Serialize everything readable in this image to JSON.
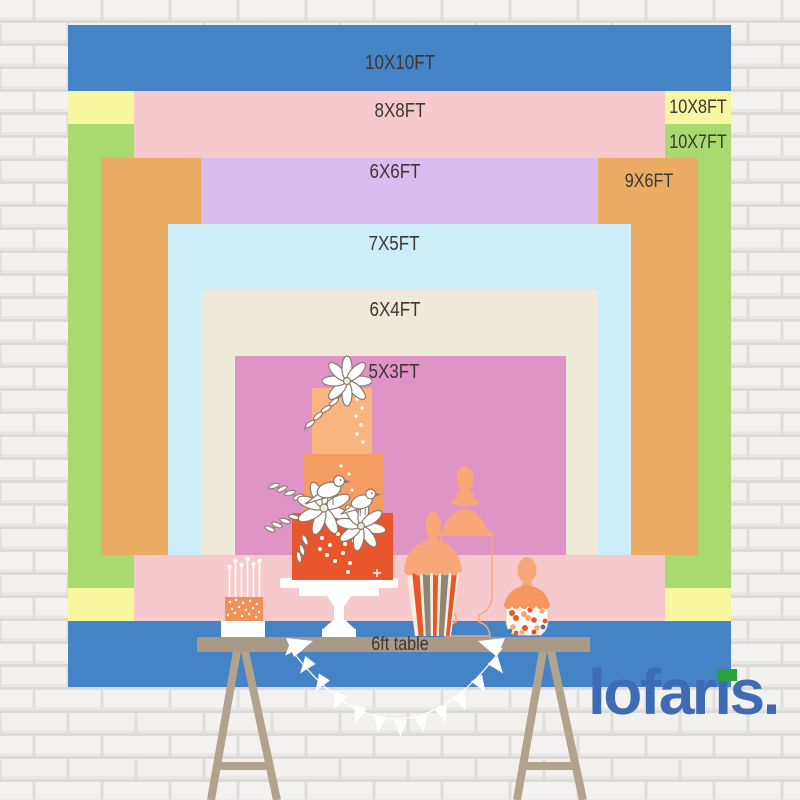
{
  "size_chart": {
    "unit": "FT",
    "layers": [
      {
        "label": "10X10FT",
        "width_ft": 10,
        "height_ft": 10,
        "color": "#4383c6"
      },
      {
        "label": "10X8FT",
        "width_ft": 10,
        "height_ft": 8,
        "color": "#f8f6a0"
      },
      {
        "label": "10X7FT",
        "width_ft": 10,
        "height_ft": 7,
        "color": "#a9da6f"
      },
      {
        "label": "8X8FT",
        "width_ft": 8,
        "height_ft": 8,
        "color": "#f6cacd"
      },
      {
        "label": "9X6FT",
        "width_ft": 9,
        "height_ft": 6,
        "color": "#ecab62"
      },
      {
        "label": "6X6FT",
        "width_ft": 6,
        "height_ft": 6,
        "color": "#dcbcee"
      },
      {
        "label": "7X5FT",
        "width_ft": 7,
        "height_ft": 5,
        "color": "#cdeef8"
      },
      {
        "label": "6X4FT",
        "width_ft": 6,
        "height_ft": 4,
        "color": "#efe9d9"
      },
      {
        "label": "5X3FT",
        "width_ft": 5,
        "height_ft": 3,
        "color": "#e093c5"
      }
    ],
    "table": {
      "label": "6ft table",
      "length_ft": 6,
      "top_color": "#a89a86",
      "leg_color": "#b2a38d"
    },
    "label_text_color": "#3b3734"
  },
  "illustration": {
    "items": [
      "tiered-cake",
      "candle-cake",
      "apothecary-jar",
      "striped-popcorn-jar",
      "candy-jar",
      "pennant-banner"
    ],
    "cake_tier_colors": [
      "#f9b57f",
      "#f59c63",
      "#e8562b"
    ],
    "jar_color": "#f8a878",
    "stripe_colors": [
      "#e8562b",
      "#8b8678",
      "#f6efdf"
    ],
    "banner_color": "#ffffff"
  },
  "brand": {
    "name": "lofaris",
    "display_pre": "lofar",
    "display_i": "ı",
    "display_post": "s",
    "display_dot": ".",
    "blue": "#3e6cb4",
    "green": "#2aa23b"
  }
}
